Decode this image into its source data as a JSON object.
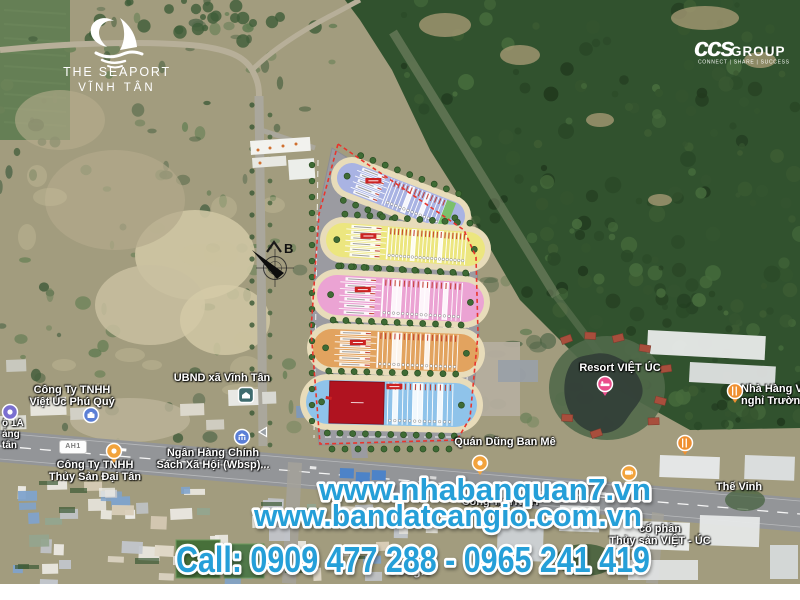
{
  "branding": {
    "seaport_logo": {
      "title": "THE SEAPORT",
      "subtitle": "VĨNH TÂN"
    },
    "ccgroup_logo": {
      "script": "ccs",
      "name": "GROUP",
      "tagline": "CONNECT | SHARE | SUCCESS"
    }
  },
  "promo_overlay": {
    "line1": "www.nhabanquan7.vn",
    "line2": "www.bandatcangio.com.vn",
    "line3": "Call: 0909 477 288 - 0965 241 419",
    "text_color": "#259fd8",
    "outline_color": "#ffffff"
  },
  "map": {
    "attribution": "Google",
    "road_badge": "AH1",
    "label_color": "#ffffff",
    "labels": [
      {
        "id": "roadside-fragment",
        "lines": [
          "ộ 1A",
          "ảng",
          "tân"
        ],
        "x": 2,
        "y": 419,
        "align": "left",
        "small": true
      },
      {
        "id": "cong-ty-viet-uc-phu-quy",
        "lines": [
          "Công Ty TNHH",
          "Việt Úc Phú Quý"
        ],
        "x": 72,
        "y": 385,
        "align": "center"
      },
      {
        "id": "ubnd-xa-vinh-tan",
        "lines": [
          "UBND xã Vĩnh Tân"
        ],
        "x": 222,
        "y": 373,
        "align": "center"
      },
      {
        "id": "cong-ty-thuy-san-dai-tan",
        "lines": [
          "Công Ty TNHH",
          "Thủy Sản Đại Tân"
        ],
        "x": 95,
        "y": 460,
        "align": "center"
      },
      {
        "id": "ngan-hang-chinh-sach",
        "lines": [
          "Ngân Hàng Chính",
          "Sách Xã Hội (Wbsp)..."
        ],
        "x": 213,
        "y": 448,
        "align": "center"
      },
      {
        "id": "resort-viet-uc",
        "lines": [
          "Resort VIỆT ÚC"
        ],
        "x": 620,
        "y": 363,
        "align": "center"
      },
      {
        "id": "nha-hang-truong-tho",
        "lines": [
          "Nhà Hàng Và",
          "nghỉ Trường T"
        ],
        "x": 741,
        "y": 384,
        "align": "left"
      },
      {
        "id": "quan-dung-ban-me",
        "lines": [
          "Quán Dũng Ban Mê"
        ],
        "x": 505,
        "y": 437,
        "align": "center"
      },
      {
        "id": "the-vinh",
        "lines": [
          "Thế Vinh"
        ],
        "x": 739,
        "y": 482,
        "align": "center"
      },
      {
        "id": "cong-ty-tnhh",
        "lines": [
          "Công Ty TNHH"
        ],
        "x": 500,
        "y": 497,
        "align": "center"
      },
      {
        "id": "thuy-san-viet-uc",
        "lines": [
          "cổ phần",
          "Thủy sản VIỆT - ÚC"
        ],
        "x": 660,
        "y": 524,
        "align": "center"
      }
    ],
    "pois": [
      {
        "id": "transit-stop",
        "icon": "dot",
        "color": "#7a6fd0",
        "x": 1,
        "y": 403,
        "stem": false
      },
      {
        "id": "briefcase",
        "icon": "briefcase",
        "color": "#5b7fd6",
        "x": 82,
        "y": 406,
        "stem": false
      },
      {
        "id": "government",
        "icon": "government",
        "color": "#3e6b6e",
        "x": 237,
        "y": 386,
        "stem": false
      },
      {
        "id": "pin-dai-tan",
        "icon": "pin",
        "color": "#f2a33c",
        "x": 105,
        "y": 442,
        "stem": true
      },
      {
        "id": "bank",
        "icon": "bank",
        "color": "#5b7fd6",
        "x": 233,
        "y": 428,
        "stem": false
      },
      {
        "id": "hotel",
        "icon": "hotel",
        "color": "#ea4d8b",
        "x": 596,
        "y": 375,
        "stem": true
      },
      {
        "id": "restaurant-1",
        "icon": "restaurant",
        "color": "#ef8f30",
        "x": 726,
        "y": 382,
        "stem": true
      },
      {
        "id": "restaurant-2",
        "icon": "restaurant",
        "color": "#ef8f30",
        "x": 676,
        "y": 434,
        "stem": true
      },
      {
        "id": "pin-ban-me",
        "icon": "pin",
        "color": "#f2a33c",
        "x": 471,
        "y": 454,
        "stem": true
      },
      {
        "id": "cafe",
        "icon": "cafe",
        "color": "#f2a33c",
        "x": 620,
        "y": 464,
        "stem": true
      },
      {
        "id": "arrow",
        "icon": "arrow-left",
        "color": "#9aa0a6",
        "x": 253,
        "y": 423,
        "stem": false
      }
    ]
  },
  "site_plan": {
    "compass_label": "B",
    "boundary_color": "#e8352c",
    "road_color": "#9b9ba1",
    "sidewalk_color": "#e8dcba",
    "tree_color": "#3f6b35",
    "tree_edge_color": "#2a4d22",
    "badge_color": "#cc2222",
    "blocks": [
      {
        "name": "row-A",
        "color": "#a9b3e3"
      },
      {
        "name": "row-B",
        "color": "#ece67f"
      },
      {
        "name": "row-C",
        "color": "#eba3d3"
      },
      {
        "name": "row-D",
        "color": "#e2a35f"
      },
      {
        "name": "row-E",
        "color": "#8fc3ea"
      }
    ],
    "special_lots": {
      "commercial_color": "#b01320",
      "green_color": "#7cc06b"
    }
  }
}
